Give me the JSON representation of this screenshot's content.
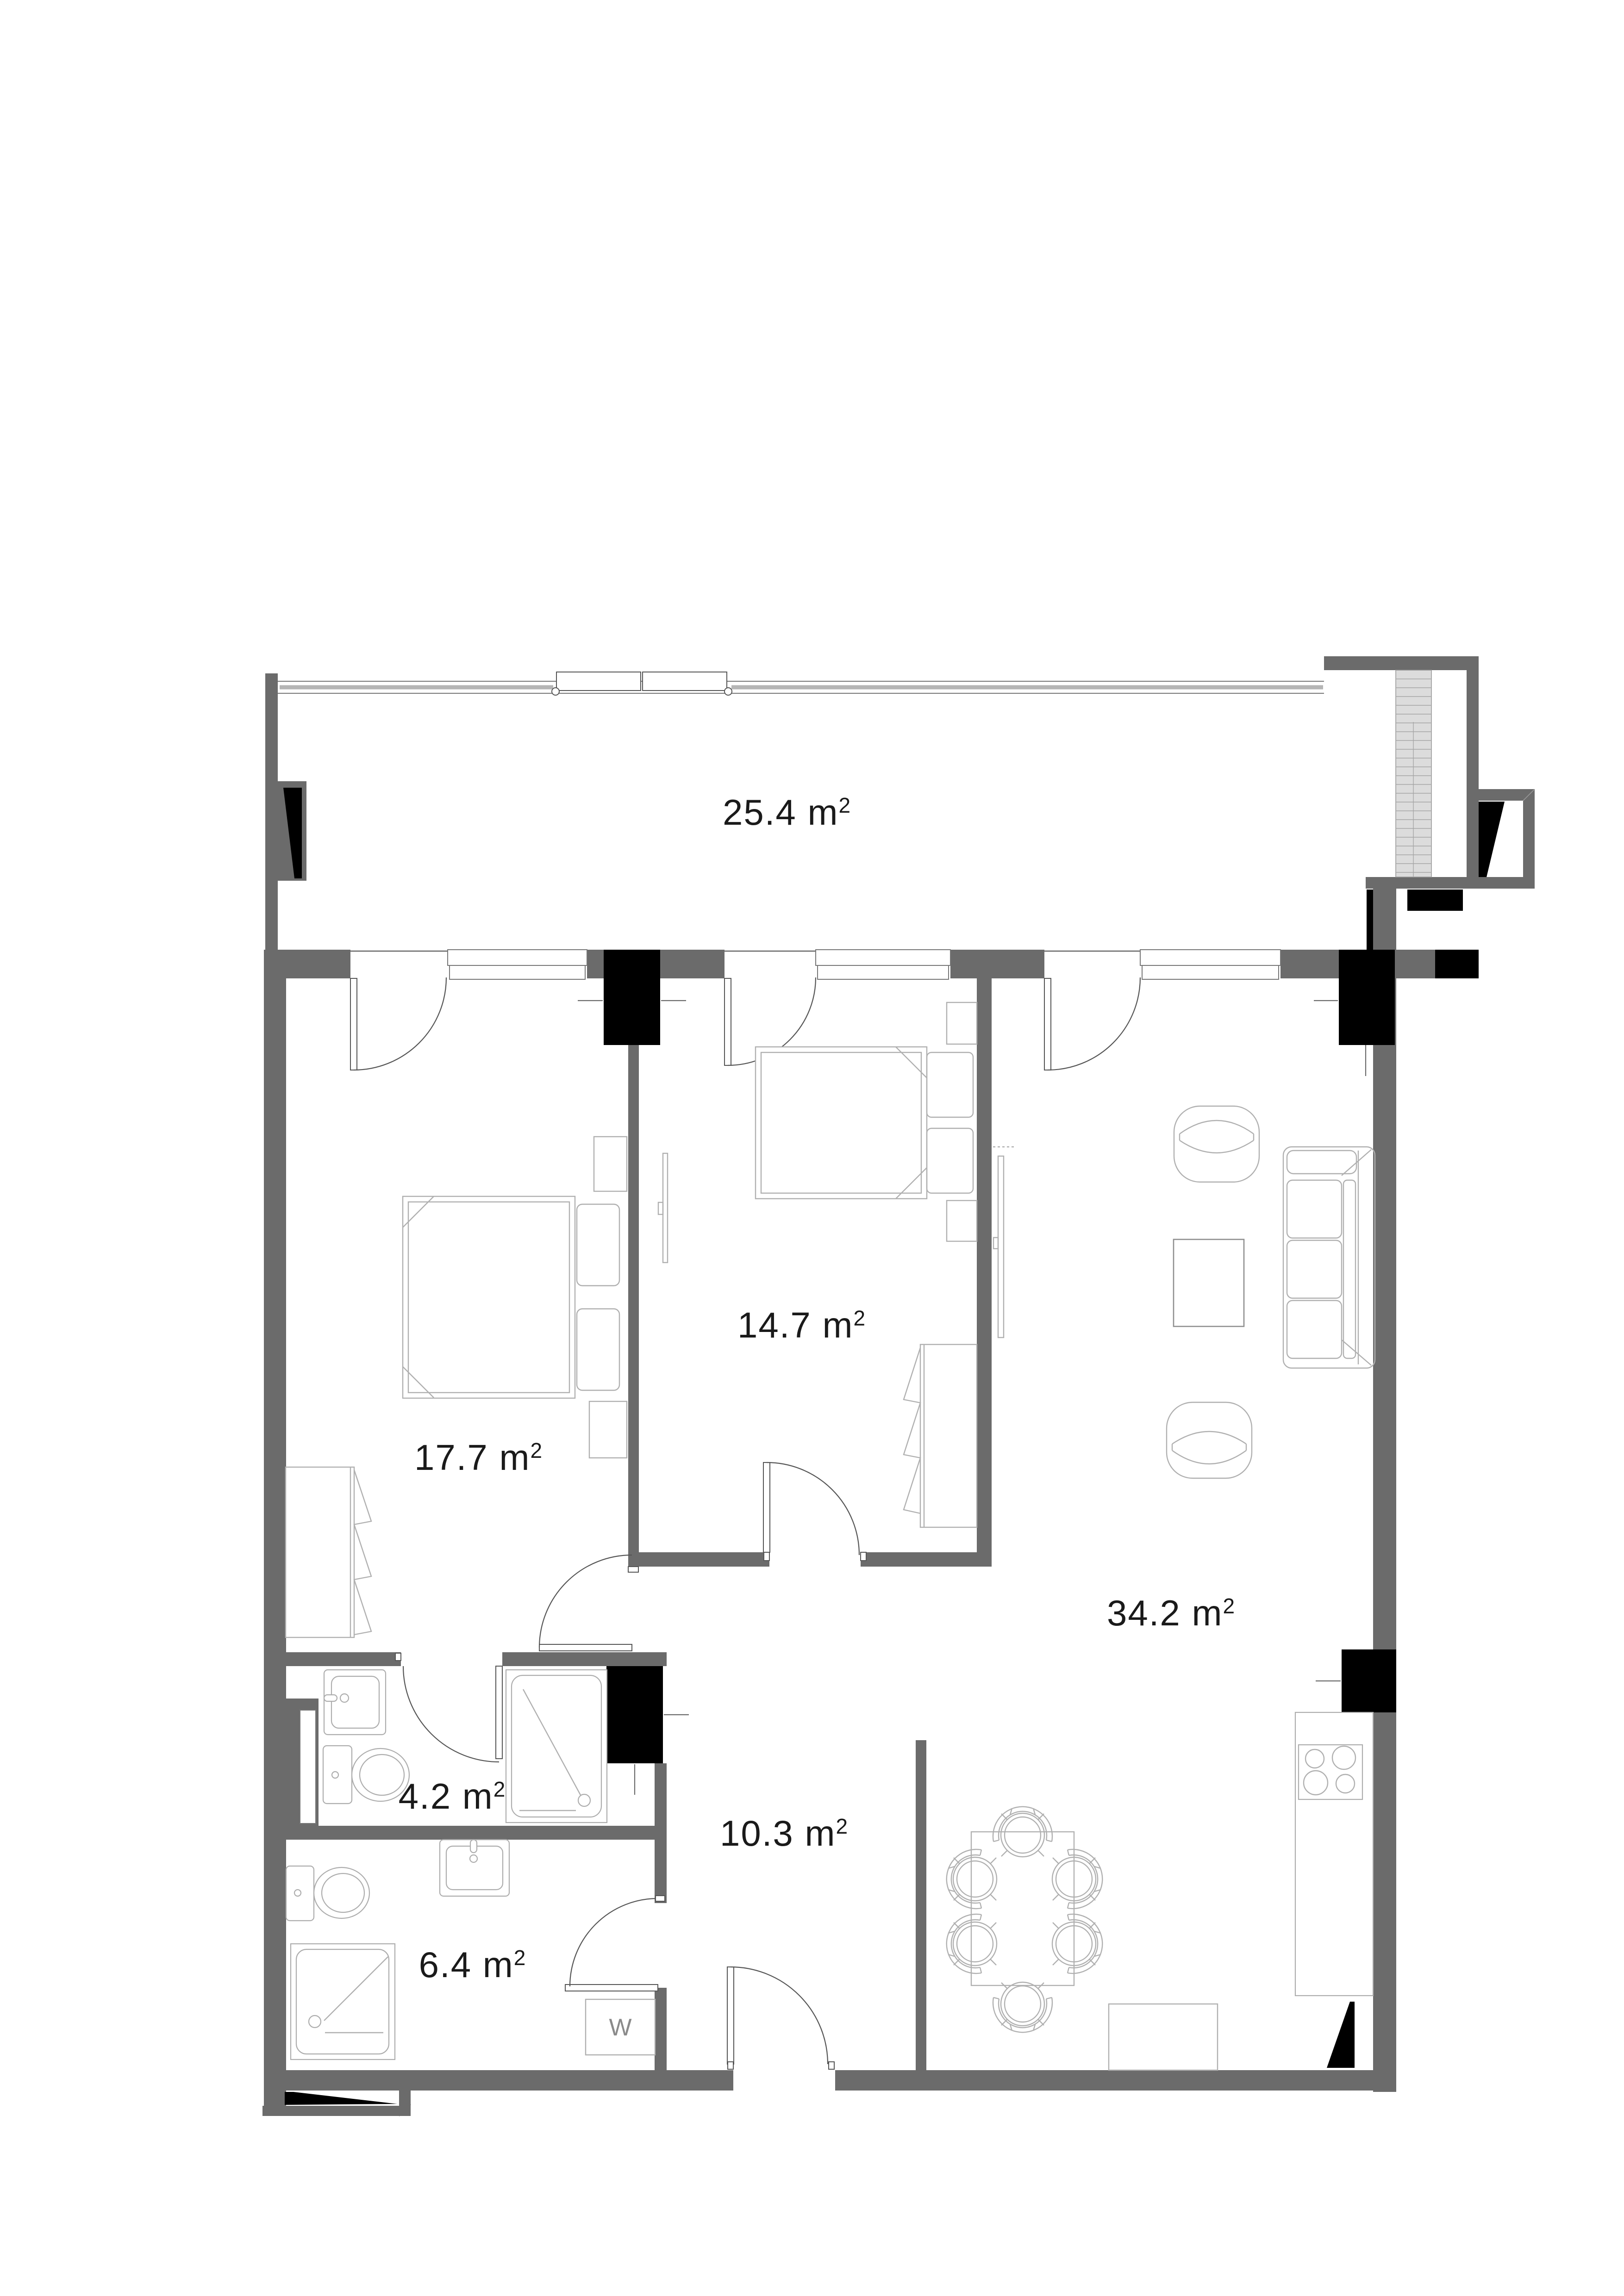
{
  "floorplan": {
    "unit": " m",
    "unit_exponent": "2",
    "rooms": [
      {
        "id": "balcony",
        "area_value": "25.4"
      },
      {
        "id": "bedroom-1",
        "area_value": "17.7"
      },
      {
        "id": "bedroom-2",
        "area_value": "14.7"
      },
      {
        "id": "living-room",
        "area_value": "34.2"
      },
      {
        "id": "bathroom-1",
        "area_value": "4.2"
      },
      {
        "id": "hallway",
        "area_value": "10.3"
      },
      {
        "id": "bathroom-2",
        "area_value": "6.4"
      }
    ],
    "appliances": {
      "washing_machine_label": "W"
    },
    "colors": {
      "wall": "#6b6b6b",
      "column": "#000000",
      "furniture_line": "#b0b0b0",
      "detail_line": "#555555",
      "hatch_fill": "#dcdcdc",
      "label_text": "#1a1a1a",
      "washer_text": "#8a8a8a",
      "background": "#ffffff"
    }
  }
}
